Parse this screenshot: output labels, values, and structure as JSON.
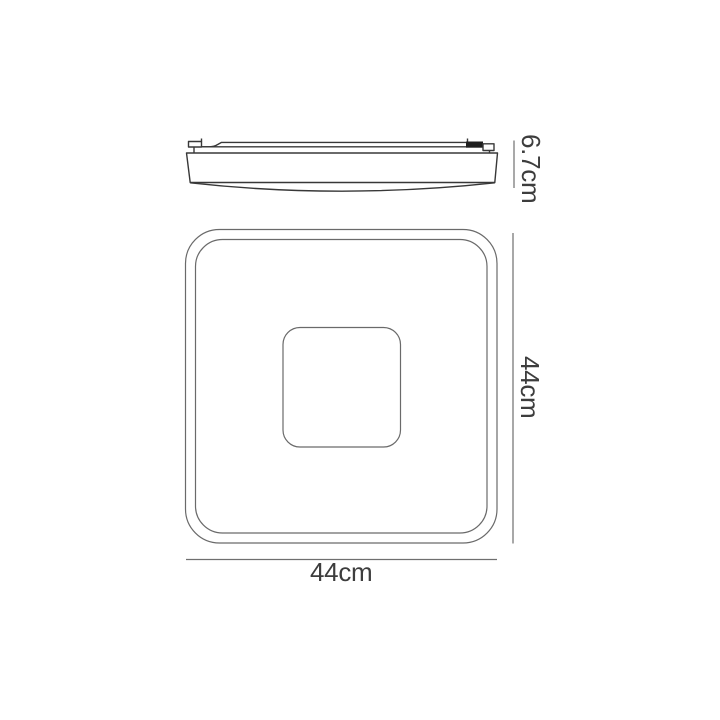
{
  "diagram": {
    "kind": "product-dimension-drawing",
    "side_view": {
      "name": "side profile view of flat square ceiling light",
      "height_dimension": {
        "label": "6.7cm"
      }
    },
    "top_view": {
      "name": "top plan view of square ceiling light with centre panel",
      "height_dimension": {
        "label": "44cm"
      },
      "width_dimension": {
        "label": "44cm"
      }
    },
    "colors": {
      "background": "#ffffff",
      "side_outline": "#383838",
      "top_outline": "#6a6a6a",
      "dimension_line": "#6f6f6f",
      "text": "#3d3d3d",
      "clip_fill": "#1f1f1f"
    }
  }
}
